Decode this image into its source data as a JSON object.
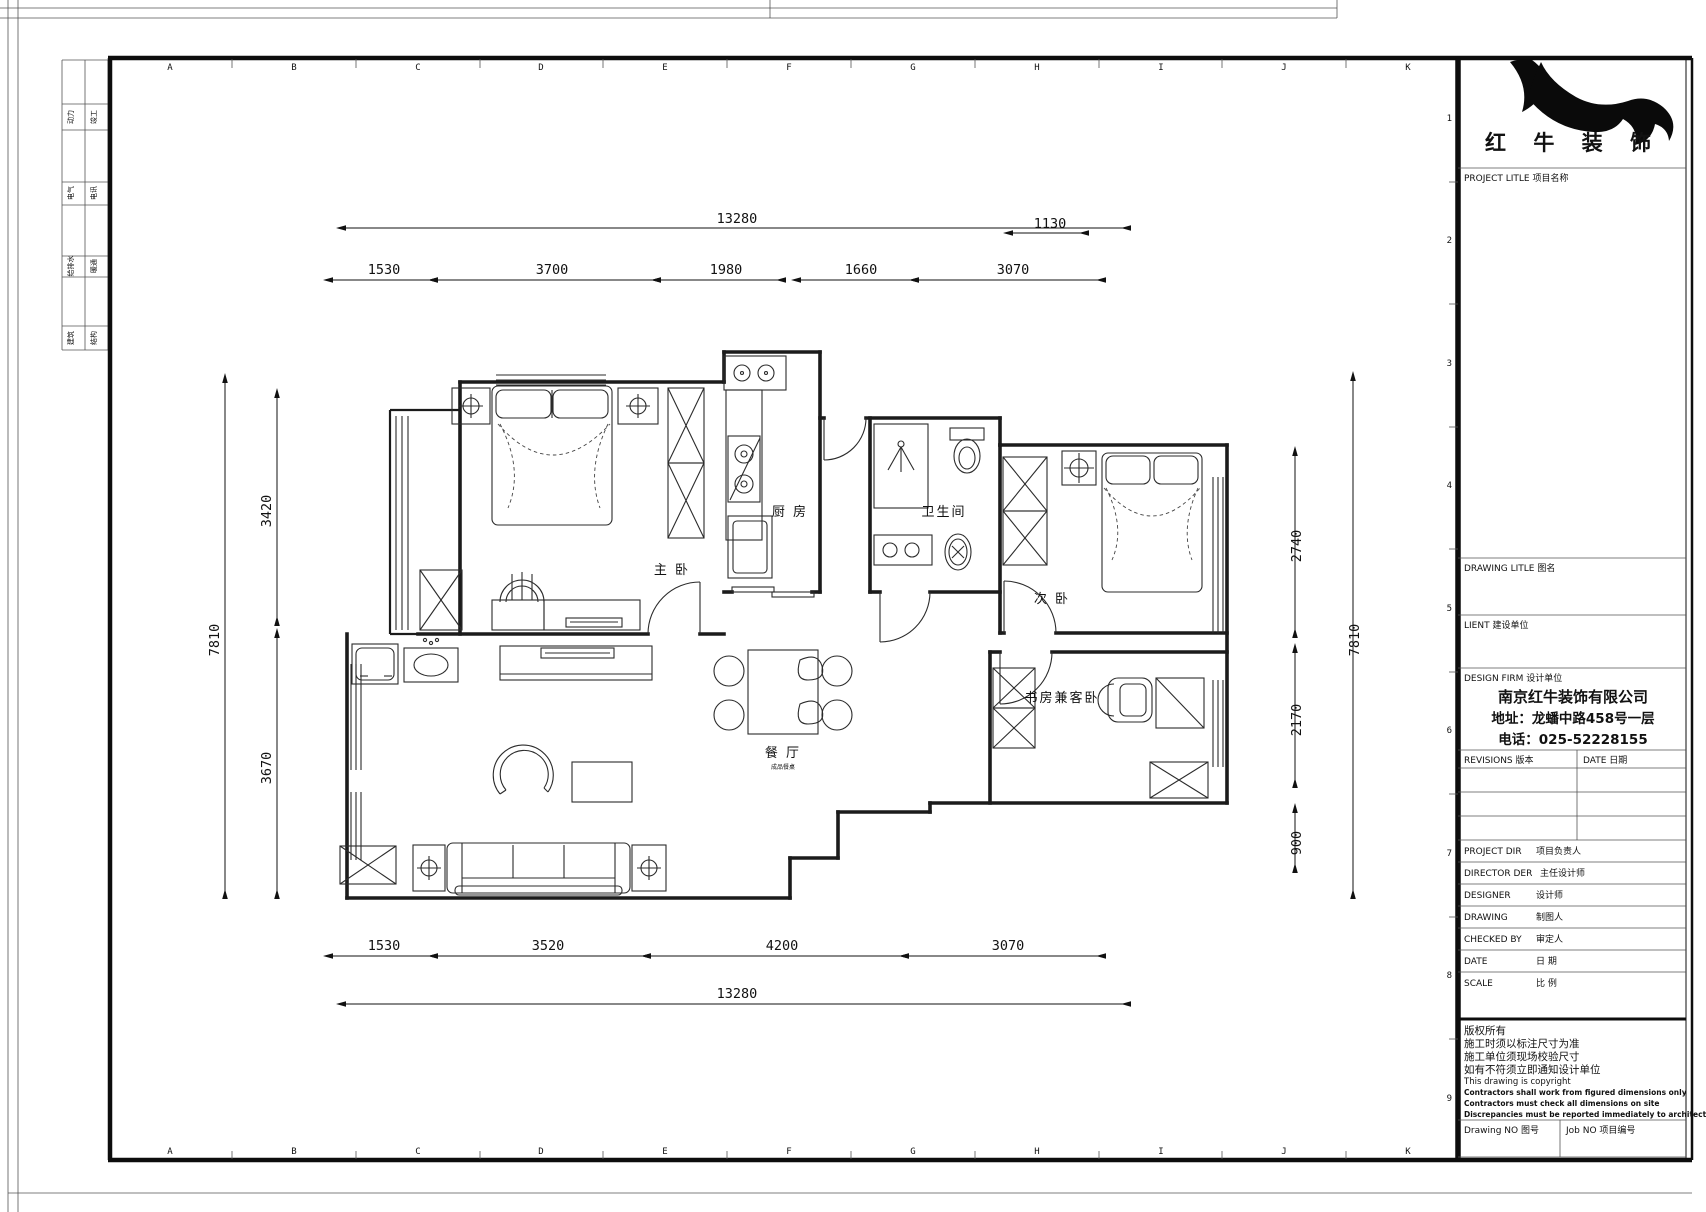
{
  "page": {
    "bg": "#ffffff",
    "line_color": "#1a1a1a"
  },
  "frame": {
    "grid_cols": [
      "A",
      "B",
      "C",
      "D",
      "E",
      "F",
      "G",
      "H",
      "I",
      "J",
      "K"
    ],
    "grid_rows": [
      "1",
      "2",
      "3",
      "4",
      "5",
      "6",
      "7",
      "8",
      "9"
    ]
  },
  "margin_table": {
    "rows": [
      {
        "c1": "动力",
        "c2": "竣工"
      },
      {
        "c1": "电气",
        "c2": "电讯"
      },
      {
        "c1": "给排水",
        "c2": "暖通"
      },
      {
        "c1": "建筑",
        "c2": "结构"
      }
    ]
  },
  "rooms": {
    "master": "主 卧",
    "kitchen": "厨 房",
    "bath": "卫生间",
    "bedroom2": "次 卧",
    "study": "书房兼客卧",
    "dining": "餐 厅",
    "dining_note": "成品餐桌"
  },
  "dims": {
    "top_total": "13280",
    "top_offset": "1130",
    "top_row": [
      "1530",
      "3700",
      "1980",
      "1660",
      "3070"
    ],
    "bottom_row": [
      "1530",
      "3520",
      "4200",
      "3070"
    ],
    "bottom_total": "13280",
    "left_total": "7810",
    "left_row": [
      "3420",
      "3670"
    ],
    "right_row": [
      "2740",
      "2170",
      "900"
    ],
    "right_total": "7810"
  },
  "title_block": {
    "brand": "红 牛 装 饰",
    "project_label": "PROJECT LITLE  项目名称",
    "drawing_label": "DRAWING LITLE  图名",
    "client_label": "LIENT  建设单位",
    "firm_label": "DESIGN FIRM  设计单位",
    "firm_name": "南京红牛装饰有限公司",
    "firm_address": "地址：龙蟠中路458号一层",
    "firm_phone": "电话：025-52228155",
    "revisions_label": "REVISIONS  版本",
    "date_col_label": "DATE  日期",
    "rows": [
      {
        "en": "PROJECT DIR",
        "cn": "项目负责人"
      },
      {
        "en": "DIRECTOR DER",
        "cn": "主任设计师"
      },
      {
        "en": "DESIGNER",
        "cn": "设计师"
      },
      {
        "en": "DRAWING",
        "cn": "制图人"
      },
      {
        "en": "CHECKED BY",
        "cn": "审定人"
      },
      {
        "en": "DATE",
        "cn": "日  期"
      },
      {
        "en": "SCALE",
        "cn": "比  例"
      }
    ],
    "copyright": [
      "版权所有",
      "施工时须以标注尺寸为准",
      "施工单位须现场校验尺寸",
      "如有不符须立即通知设计单位",
      "This drawing is copyright",
      "Contractors shall work from figured dimensions only",
      "Contractors must check all dimensions on site",
      "Discrepancies must be reported immediately to architects"
    ],
    "drawing_no_label": "Drawing NO  图号",
    "job_no_label": "Job NO  项目编号"
  }
}
